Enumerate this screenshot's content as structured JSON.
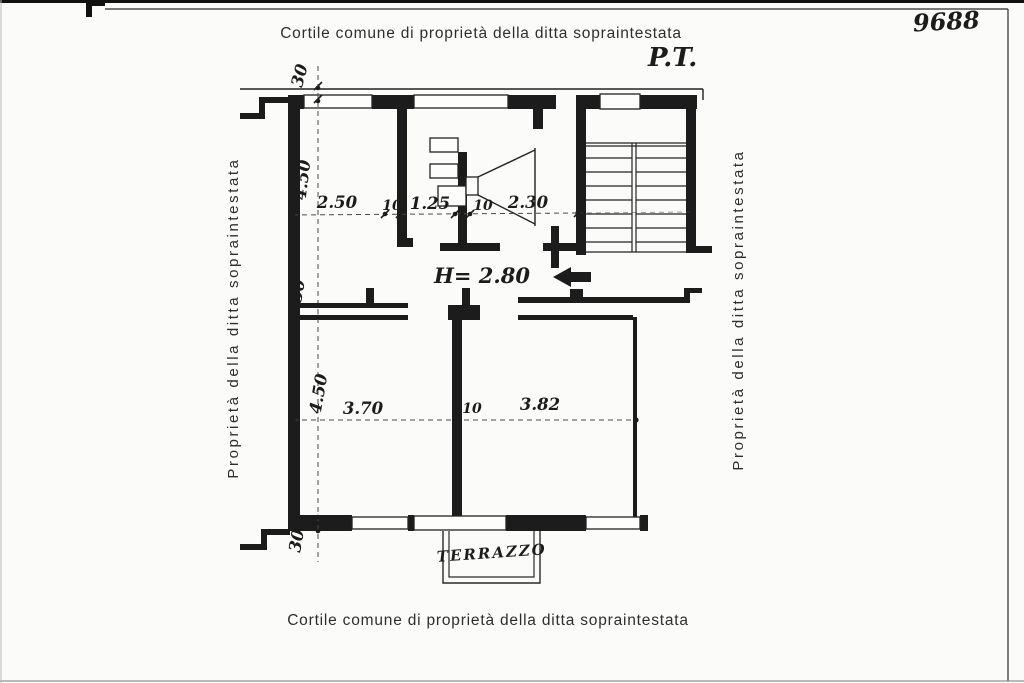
{
  "page": {
    "sheet_number": "9688",
    "floor_label": "P.T.",
    "background": "#fbfbf9",
    "ink_color": "#1c1c1c"
  },
  "captions": {
    "top": "Cortile comune di proprietà della ditta sopraintestata",
    "bottom": "Cortile comune di proprietà della ditta sopraintestata",
    "left": "Proprietà della ditta sopraintestata",
    "right": "Proprietà della ditta sopraintestata"
  },
  "plan": {
    "terrace_label": "TERRAZZO",
    "height_note": "H= 2.80",
    "icons": {
      "corridor_arrow": "left-arrow"
    },
    "dims": {
      "top": [
        "2.50",
        "10",
        "1.25",
        "10",
        "2.30"
      ],
      "bottom": [
        "3.70",
        "10",
        "3.82"
      ],
      "upper_room_depth": "4.50",
      "lower_room_depth": "4.50",
      "wall_top": "30",
      "wall_mid": "30",
      "wall_bottom": "30"
    }
  }
}
